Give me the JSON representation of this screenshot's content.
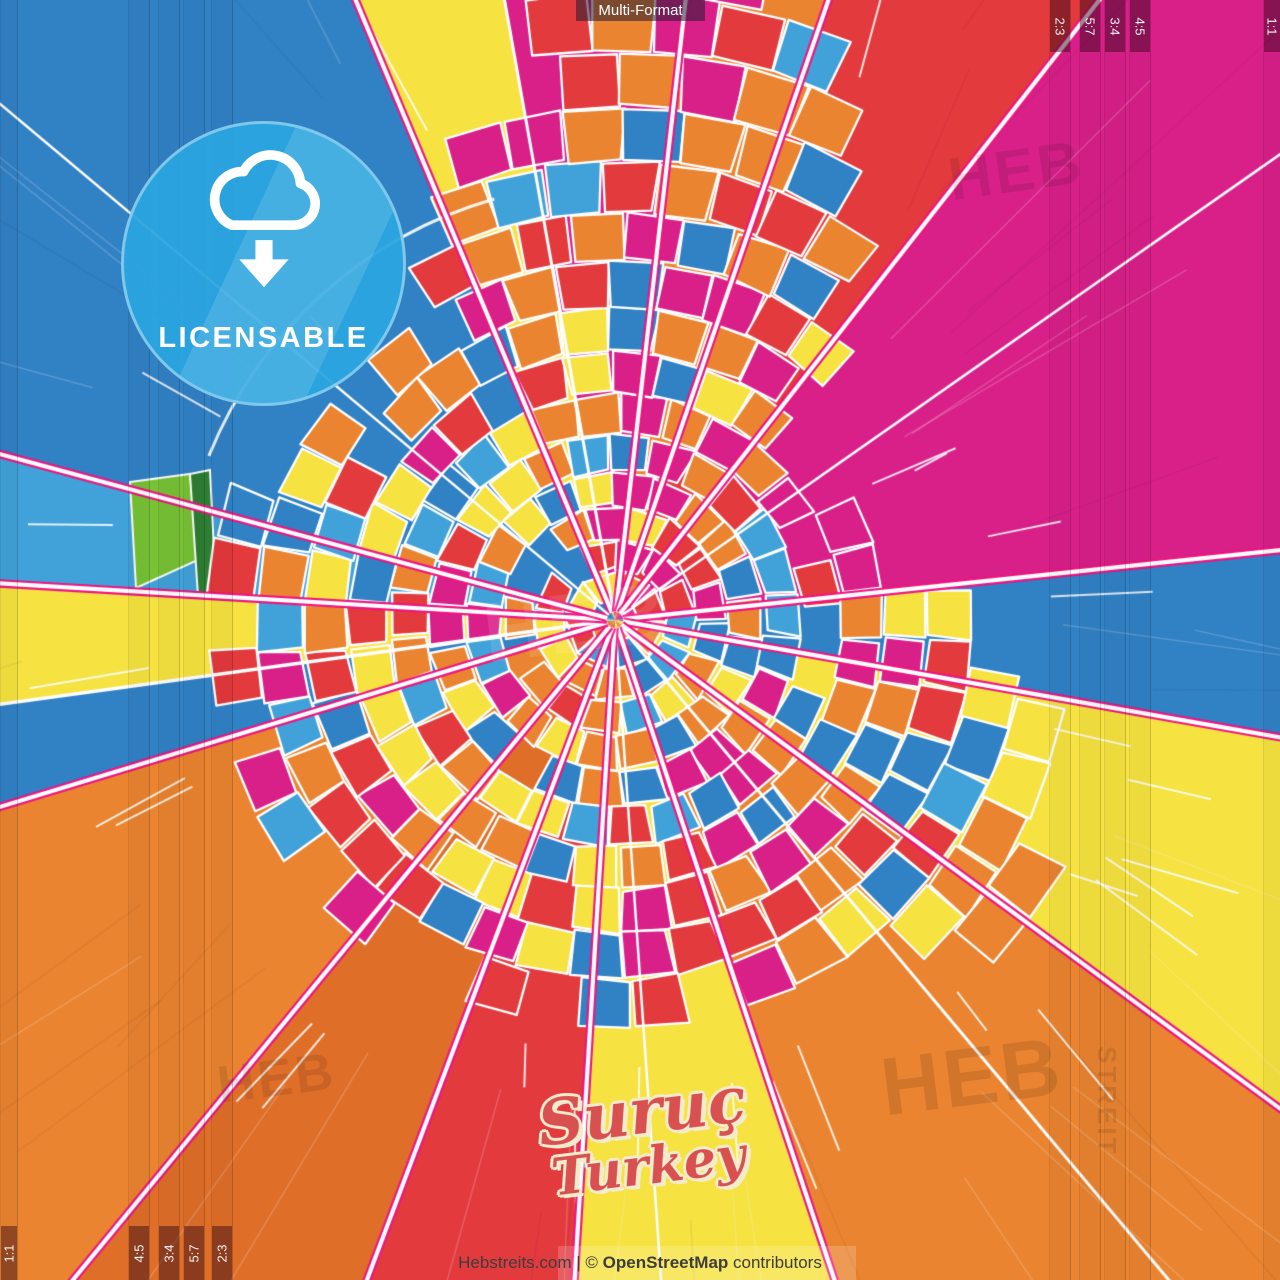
{
  "top_label": {
    "text": "Multi-Format"
  },
  "badge": {
    "label": "LICENSABLE",
    "color": "#2BA5DF",
    "icon": "cloud-download-icon"
  },
  "title": {
    "city": "Suruç",
    "country": "Turkey",
    "text_color": "#D85050",
    "outline_color": "#F3ECCC"
  },
  "attribution": {
    "site": "Hebstreits.com",
    "separator": " | © ",
    "osm": "OpenStreetMap",
    "suffix": " contributors"
  },
  "ratio_markers": {
    "right": [
      {
        "label": "2:3",
        "x": 1049
      },
      {
        "label": "5:7",
        "x": 1079
      },
      {
        "label": "3:4",
        "x": 1104
      },
      {
        "label": "4:5",
        "x": 1129
      }
    ],
    "right_corner": {
      "label": "1:1",
      "x": 1263,
      "w": 17
    },
    "left": [
      {
        "label": "4:5",
        "x": 128
      },
      {
        "label": "3:4",
        "x": 158
      },
      {
        "label": "5:7",
        "x": 183
      },
      {
        "label": "2:3",
        "x": 211
      }
    ],
    "left_corner": {
      "label": "1:1",
      "x": 0,
      "w": 16
    }
  },
  "watermarks": [
    {
      "text": "HEB",
      "x": 944,
      "y": 146,
      "size": 60,
      "rot": -8,
      "color": "rgba(0,0,0,0.10)"
    },
    {
      "text": "HEB",
      "x": 478,
      "y": 586,
      "size": 84,
      "rot": -7,
      "color": "rgba(255,255,255,0.10)"
    },
    {
      "text": "HEB",
      "x": 214,
      "y": 1056,
      "size": 52,
      "rot": -7,
      "color": "rgba(0,0,0,0.10)"
    },
    {
      "text": "HEB",
      "x": 876,
      "y": 1042,
      "size": 82,
      "rot": -7,
      "color": "rgba(0,0,0,0.11)"
    },
    {
      "text": "STREIT",
      "x": 1122,
      "y": 1046,
      "size": 26,
      "rot": 90,
      "color": "rgba(0,0,0,0.10)"
    }
  ],
  "map": {
    "center": {
      "x": 615,
      "y": 620
    },
    "seed": 11,
    "palette": {
      "blue": "#3181C5",
      "lightblue": "#41A2D9",
      "magenta": "#D92089",
      "red": "#E33A3E",
      "orange": "#EA8430",
      "darkorange": "#DF6E29",
      "yellow": "#F6E240",
      "casing": "#EF1480",
      "street": "#FFFFFF",
      "green_light": "#79C236",
      "green_dark": "#2E7F33"
    },
    "wedges": [
      [
        349.9,
        6.5,
        "magenta"
      ],
      [
        6.5,
        19,
        "orange"
      ],
      [
        19,
        38,
        "red"
      ],
      [
        38,
        84,
        "magenta"
      ],
      [
        84,
        100,
        "blue"
      ],
      [
        100,
        126.3,
        "yellow"
      ],
      [
        126.3,
        161.6,
        "orange"
      ],
      [
        161.6,
        183.5,
        "yellow"
      ],
      [
        183.5,
        200.6,
        "red"
      ],
      [
        200.6,
        219.4,
        "darkorange"
      ],
      [
        219.4,
        253.1,
        "orange"
      ],
      [
        253.1,
        262.2,
        "blue"
      ],
      [
        262.2,
        273.4,
        "yellow"
      ],
      [
        273.4,
        285.1,
        "lightblue"
      ],
      [
        285.1,
        337.3,
        "blue"
      ],
      [
        337.3,
        349.9,
        "yellow"
      ]
    ],
    "major_roads": [
      {
        "deg": 337.3,
        "style": "cased"
      },
      {
        "deg": 349.9,
        "style": "white",
        "w": 3
      },
      {
        "deg": 6.5,
        "style": "cased"
      },
      {
        "deg": 19,
        "style": "cased"
      },
      {
        "deg": 38,
        "style": "cased"
      },
      {
        "deg": 55,
        "style": "white",
        "w": 2.5
      },
      {
        "deg": 84,
        "style": "cased"
      },
      {
        "deg": 100,
        "style": "cased"
      },
      {
        "deg": 126.3,
        "style": "cased"
      },
      {
        "deg": 140,
        "style": "white",
        "w": 3
      },
      {
        "deg": 161.6,
        "style": "cased"
      },
      {
        "deg": 176,
        "style": "white",
        "w": 2.5
      },
      {
        "deg": 183.5,
        "style": "cased"
      },
      {
        "deg": 200.6,
        "style": "cased"
      },
      {
        "deg": 219.4,
        "style": "cased"
      },
      {
        "deg": 253.1,
        "style": "cased"
      },
      {
        "deg": 262.2,
        "style": "white",
        "w": 3.5
      },
      {
        "deg": 273.4,
        "style": "cased"
      },
      {
        "deg": 285.1,
        "style": "cased"
      },
      {
        "deg": 310,
        "style": "white",
        "w": 2.5
      }
    ],
    "ring_road": {
      "r": 438,
      "from": 292,
      "to": 344
    },
    "green_fields": [
      {
        "color": "green_light",
        "pts": [
          [
            130,
            482
          ],
          [
            190,
            474
          ],
          [
            198,
            560
          ],
          [
            136,
            588
          ]
        ]
      },
      {
        "color": "green_dark",
        "pts": [
          [
            190,
            474
          ],
          [
            210,
            470
          ],
          [
            216,
            592
          ],
          [
            198,
            596
          ]
        ]
      }
    ],
    "mosaic": {
      "base": 332,
      "wave": 88,
      "lobes": [
        {
          "m": 0.22,
          "s": 0.33,
          "amp": 300
        },
        {
          "m": 3.05,
          "s": 0.42,
          "amp": 150
        },
        {
          "m": 4.93,
          "s": 0.3,
          "amp": 170
        },
        {
          "m": 2.45,
          "s": 0.4,
          "amp": 90
        }
      ],
      "weights": {
        "orange": 0.21,
        "red": 0.19,
        "magenta": 0.17,
        "yellow": 0.18,
        "blue": 0.15,
        "lightblue": 0.1
      }
    }
  }
}
